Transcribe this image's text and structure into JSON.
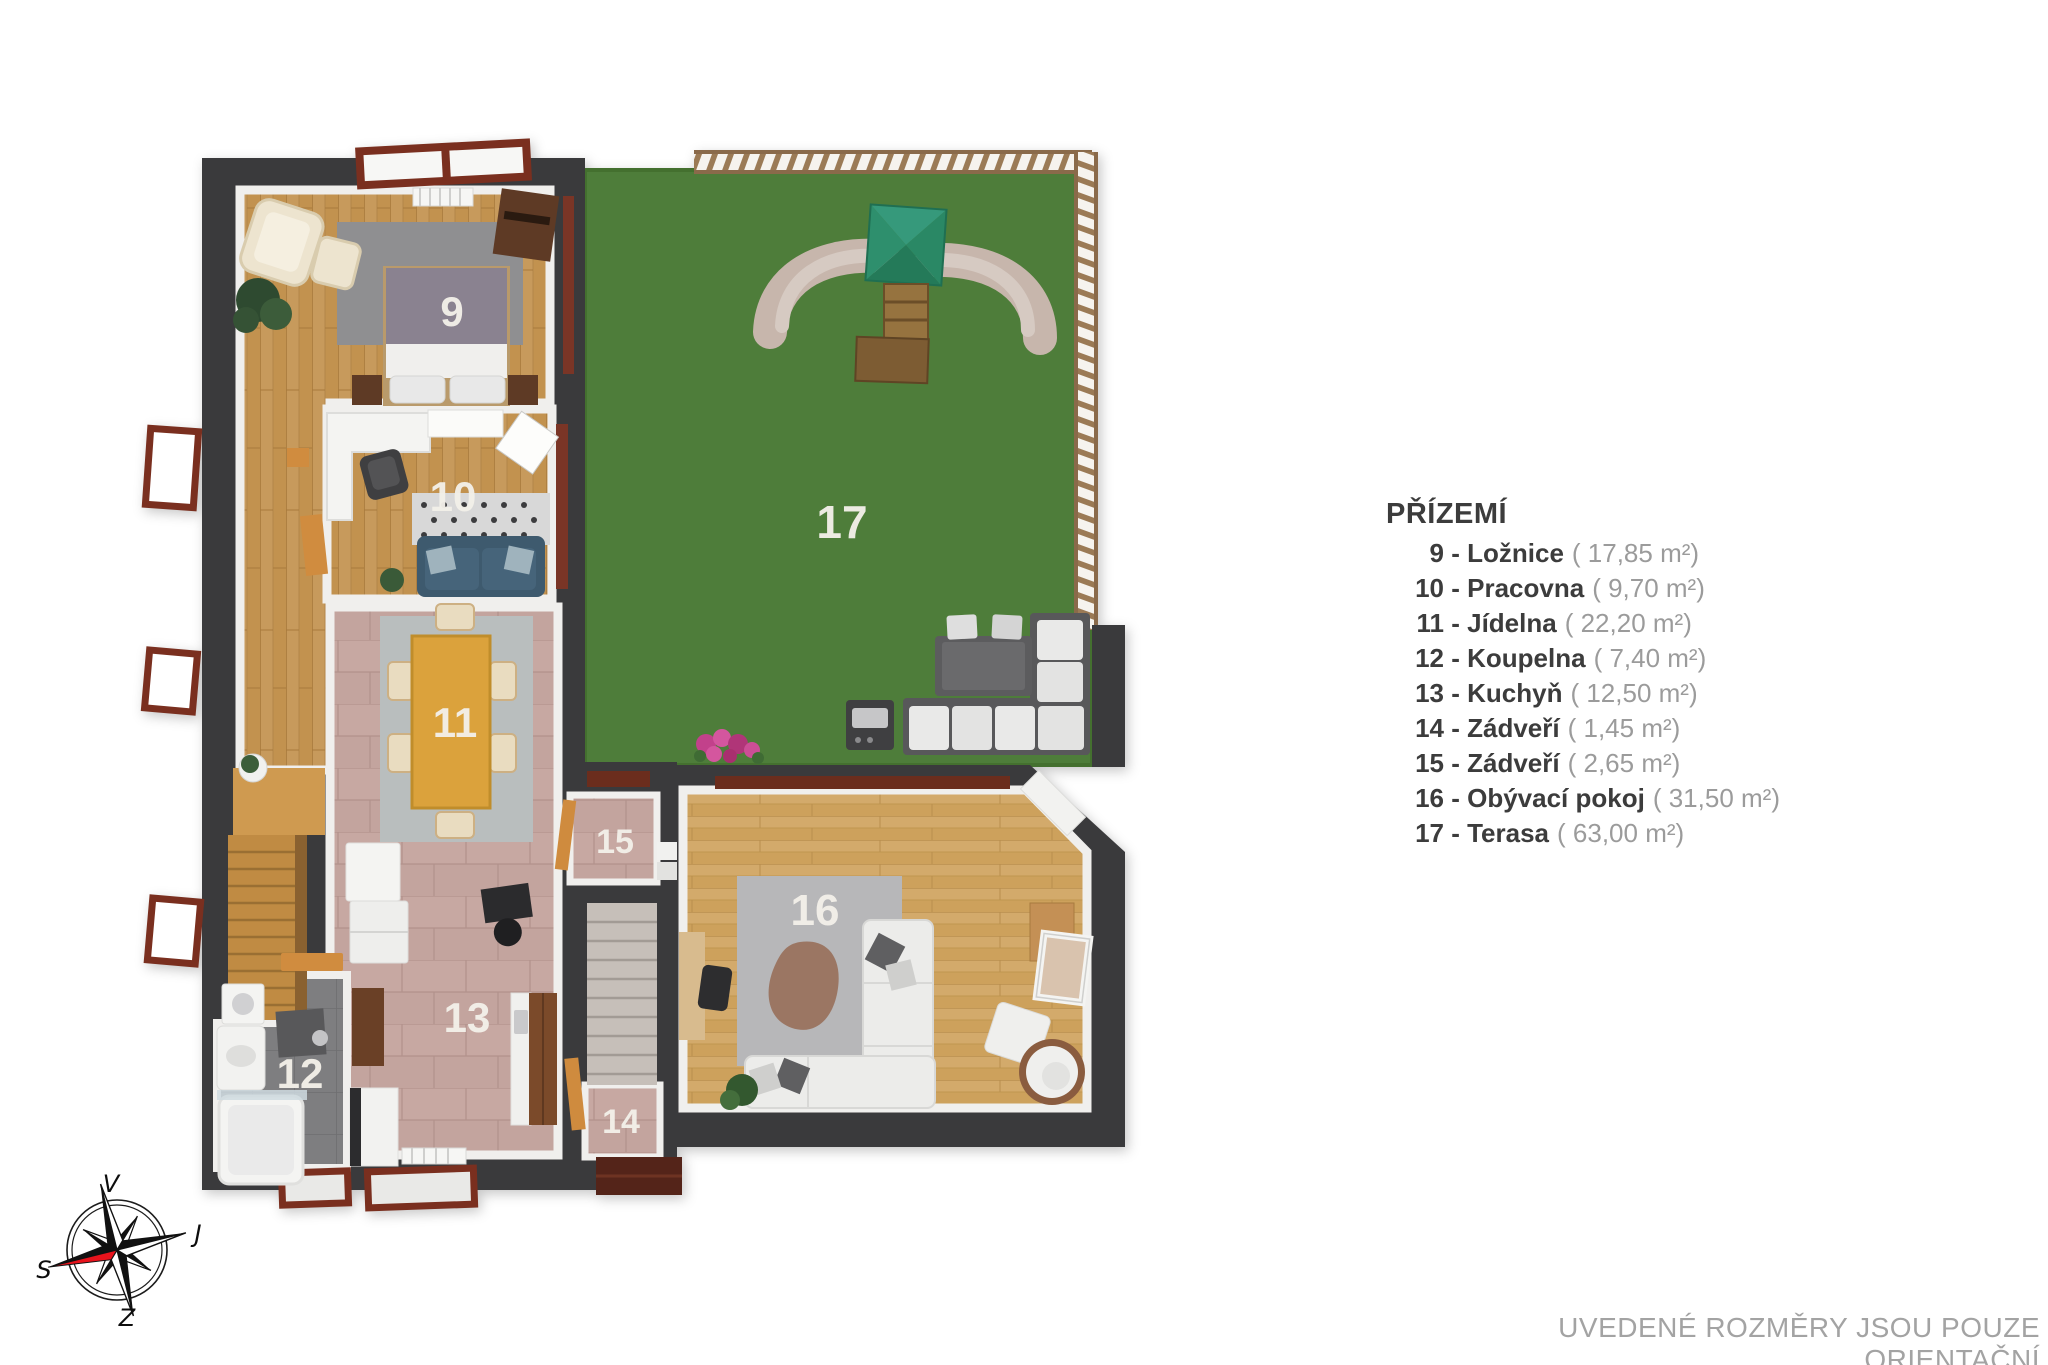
{
  "legend": {
    "title": "PŘÍZEMÍ",
    "separator": " - ",
    "items": [
      {
        "number": "9",
        "name": "Ložnice",
        "area": "( 17,85 m²)"
      },
      {
        "number": "10",
        "name": "Pracovna",
        "area": "( 9,70 m²)"
      },
      {
        "number": "11",
        "name": "Jídelna",
        "area": "( 22,20 m²)"
      },
      {
        "number": "12",
        "name": "Koupelna",
        "area": "( 7,40 m²)"
      },
      {
        "number": "13",
        "name": "Kuchyň",
        "area": "( 12,50 m²)"
      },
      {
        "number": "14",
        "name": "Zádveří",
        "area": "( 1,45 m²)"
      },
      {
        "number": "15",
        "name": "Zádveří",
        "area": "( 2,65 m²)"
      },
      {
        "number": "16",
        "name": "Obývací pokoj",
        "area": "( 31,50 m²)"
      },
      {
        "number": "17",
        "name": "Terasa",
        "area": "( 63,00 m²)"
      }
    ]
  },
  "plan": {
    "room_labels": [
      "9",
      "10",
      "11",
      "12",
      "13",
      "14",
      "15",
      "16",
      "17"
    ]
  },
  "compass": {
    "top": "V",
    "right": "J",
    "bottom": "Z",
    "left": "S"
  },
  "disclaimer": "UVEDENÉ ROZMĚRY JSOU POUZE ORIENTAČNÍ",
  "colors": {
    "wall": "#3a3a3c",
    "lawn": "#4e7d3a",
    "wood": "#c79a5c",
    "wood_light": "#d3aa6b",
    "tile_pink": "#c3a49e",
    "tile_gray": "#7d7d7f",
    "door_wood": "#d08c3f",
    "window_frame": "#7a2f1f",
    "compass_red": "#e8131c"
  }
}
